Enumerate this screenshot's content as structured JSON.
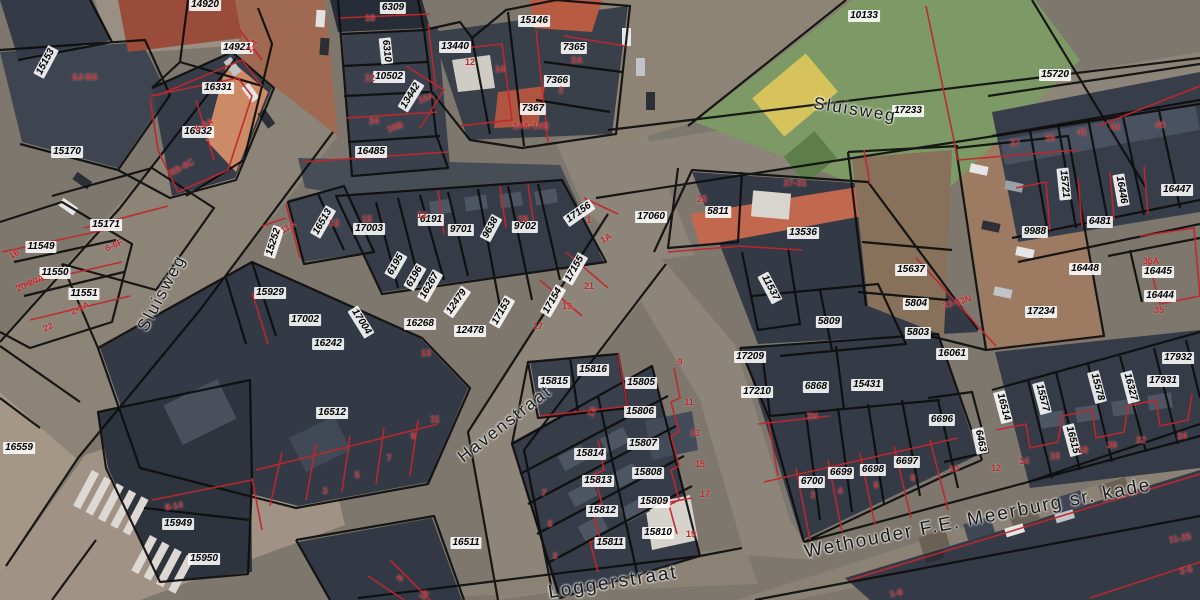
{
  "map": {
    "type": "cadastral-aerial-map",
    "colors": {
      "parcel_line": "#0d0d0d",
      "subdivision_line": "#c1272d",
      "house_number_text": "#c1272d",
      "parcel_label_bg": "#ffffff",
      "parcel_label_text": "#000000",
      "street_label_text": "#1a1a1a"
    },
    "streets": [
      {
        "name": "Sluisweg",
        "x": 855,
        "y": 110,
        "rot": 9,
        "size": 17
      },
      {
        "name": "Sluisweg",
        "x": 162,
        "y": 293,
        "rot": -62,
        "size": 17
      },
      {
        "name": "Havenstraat",
        "x": 505,
        "y": 424,
        "rot": -38,
        "size": 17
      },
      {
        "name": "Loggerstraat",
        "x": 613,
        "y": 583,
        "rot": -9,
        "size": 19
      },
      {
        "name": "Wethouder F.E. Meerburg sr. kade",
        "x": 978,
        "y": 519,
        "rot": -11,
        "size": 19
      }
    ],
    "parcel_labels": [
      {
        "id": "14920",
        "x": 205,
        "y": 5
      },
      {
        "id": "14921",
        "x": 237,
        "y": 48
      },
      {
        "id": "15153",
        "x": 46,
        "y": 62,
        "rot": -62
      },
      {
        "id": "16331",
        "x": 218,
        "y": 88
      },
      {
        "id": "16332",
        "x": 198,
        "y": 132
      },
      {
        "id": "15170",
        "x": 67,
        "y": 152
      },
      {
        "id": "6309",
        "x": 393,
        "y": 8
      },
      {
        "id": "6310",
        "x": 386,
        "y": 51,
        "rot": 84
      },
      {
        "id": "10502",
        "x": 389,
        "y": 77
      },
      {
        "id": "13442",
        "x": 411,
        "y": 96,
        "rot": -58
      },
      {
        "id": "16485",
        "x": 371,
        "y": 152
      },
      {
        "id": "13440",
        "x": 455,
        "y": 47
      },
      {
        "id": "15146",
        "x": 534,
        "y": 21
      },
      {
        "id": "7365",
        "x": 574,
        "y": 48
      },
      {
        "id": "7366",
        "x": 557,
        "y": 81
      },
      {
        "id": "7367",
        "x": 533,
        "y": 109
      },
      {
        "id": "10133",
        "x": 864,
        "y": 16
      },
      {
        "id": "17233",
        "x": 908,
        "y": 111
      },
      {
        "id": "15720",
        "x": 1055,
        "y": 75
      },
      {
        "id": "15721",
        "x": 1064,
        "y": 184,
        "rot": 84
      },
      {
        "id": "16446",
        "x": 1121,
        "y": 190,
        "rot": 80
      },
      {
        "id": "16447",
        "x": 1177,
        "y": 190
      },
      {
        "id": "9988",
        "x": 1035,
        "y": 232
      },
      {
        "id": "6481",
        "x": 1100,
        "y": 222
      },
      {
        "id": "16448",
        "x": 1085,
        "y": 269
      },
      {
        "id": "16445",
        "x": 1158,
        "y": 272
      },
      {
        "id": "16444",
        "x": 1160,
        "y": 296
      },
      {
        "id": "17234",
        "x": 1041,
        "y": 312
      },
      {
        "id": "17060",
        "x": 651,
        "y": 217
      },
      {
        "id": "5811",
        "x": 718,
        "y": 212
      },
      {
        "id": "13536",
        "x": 803,
        "y": 233
      },
      {
        "id": "15637",
        "x": 911,
        "y": 270
      },
      {
        "id": "5804",
        "x": 916,
        "y": 304
      },
      {
        "id": "5809",
        "x": 829,
        "y": 322
      },
      {
        "id": "5803",
        "x": 918,
        "y": 333
      },
      {
        "id": "11537",
        "x": 770,
        "y": 288,
        "rot": 62
      },
      {
        "id": "16061",
        "x": 952,
        "y": 354
      },
      {
        "id": "17209",
        "x": 750,
        "y": 357
      },
      {
        "id": "17210",
        "x": 757,
        "y": 392
      },
      {
        "id": "6868",
        "x": 816,
        "y": 387
      },
      {
        "id": "15431",
        "x": 867,
        "y": 385
      },
      {
        "id": "6696",
        "x": 942,
        "y": 420
      },
      {
        "id": "6697",
        "x": 907,
        "y": 462
      },
      {
        "id": "6698",
        "x": 873,
        "y": 470
      },
      {
        "id": "6699",
        "x": 841,
        "y": 473
      },
      {
        "id": "6700",
        "x": 812,
        "y": 482
      },
      {
        "id": "6463",
        "x": 980,
        "y": 441,
        "rot": 78
      },
      {
        "id": "17932",
        "x": 1178,
        "y": 358
      },
      {
        "id": "17931",
        "x": 1163,
        "y": 381
      },
      {
        "id": "16327",
        "x": 1130,
        "y": 387,
        "rot": 75
      },
      {
        "id": "15578",
        "x": 1097,
        "y": 387,
        "rot": 75
      },
      {
        "id": "15577",
        "x": 1042,
        "y": 398,
        "rot": 75
      },
      {
        "id": "16514",
        "x": 1003,
        "y": 407,
        "rot": 75
      },
      {
        "id": "16515",
        "x": 1072,
        "y": 440,
        "rot": 75
      },
      {
        "id": "15252",
        "x": 274,
        "y": 242,
        "rot": -72
      },
      {
        "id": "15929",
        "x": 270,
        "y": 293
      },
      {
        "id": "15171",
        "x": 106,
        "y": 225
      },
      {
        "id": "11549",
        "x": 41,
        "y": 247
      },
      {
        "id": "11550",
        "x": 55,
        "y": 273
      },
      {
        "id": "11551",
        "x": 84,
        "y": 294
      },
      {
        "id": "17002",
        "x": 305,
        "y": 320
      },
      {
        "id": "17004",
        "x": 361,
        "y": 322,
        "rot": 58
      },
      {
        "id": "16242",
        "x": 328,
        "y": 344
      },
      {
        "id": "16512",
        "x": 332,
        "y": 413
      },
      {
        "id": "17003",
        "x": 369,
        "y": 229
      },
      {
        "id": "16513",
        "x": 323,
        "y": 222,
        "rot": -60
      },
      {
        "id": "6191",
        "x": 431,
        "y": 220
      },
      {
        "id": "9701",
        "x": 461,
        "y": 230
      },
      {
        "id": "9638",
        "x": 491,
        "y": 228,
        "rot": -62
      },
      {
        "id": "9702",
        "x": 525,
        "y": 227
      },
      {
        "id": "17156",
        "x": 579,
        "y": 213,
        "rot": -35
      },
      {
        "id": "6195",
        "x": 396,
        "y": 265,
        "rot": -60
      },
      {
        "id": "6196",
        "x": 415,
        "y": 277,
        "rot": -60
      },
      {
        "id": "16267",
        "x": 430,
        "y": 286,
        "rot": -60
      },
      {
        "id": "12479",
        "x": 457,
        "y": 302,
        "rot": -55
      },
      {
        "id": "17153",
        "x": 502,
        "y": 312,
        "rot": -60
      },
      {
        "id": "17154",
        "x": 553,
        "y": 301,
        "rot": -60
      },
      {
        "id": "17155",
        "x": 575,
        "y": 269,
        "rot": -60
      },
      {
        "id": "16268",
        "x": 420,
        "y": 324
      },
      {
        "id": "12478",
        "x": 470,
        "y": 331
      },
      {
        "id": "15816",
        "x": 593,
        "y": 370
      },
      {
        "id": "15815",
        "x": 554,
        "y": 382
      },
      {
        "id": "15805",
        "x": 641,
        "y": 383
      },
      {
        "id": "15806",
        "x": 640,
        "y": 412
      },
      {
        "id": "15807",
        "x": 643,
        "y": 444
      },
      {
        "id": "15808",
        "x": 648,
        "y": 473
      },
      {
        "id": "15809",
        "x": 654,
        "y": 502
      },
      {
        "id": "15810",
        "x": 658,
        "y": 533
      },
      {
        "id": "15811",
        "x": 610,
        "y": 543
      },
      {
        "id": "15812",
        "x": 602,
        "y": 511
      },
      {
        "id": "15813",
        "x": 598,
        "y": 481
      },
      {
        "id": "15814",
        "x": 590,
        "y": 454
      },
      {
        "id": "16511",
        "x": 466,
        "y": 543
      },
      {
        "id": "15949",
        "x": 178,
        "y": 524
      },
      {
        "id": "15950",
        "x": 204,
        "y": 559
      },
      {
        "id": "16559",
        "x": 19,
        "y": 448
      }
    ],
    "house_numbers": [
      {
        "n": "2-4",
        "x": 252,
        "y": 46,
        "rot": -55
      },
      {
        "n": "6J-6G",
        "x": 85,
        "y": 77
      },
      {
        "n": "8-8A",
        "x": 204,
        "y": 125,
        "rot": -28
      },
      {
        "n": "8B-8C",
        "x": 182,
        "y": 167,
        "rot": -28
      },
      {
        "n": "18",
        "x": 370,
        "y": 18
      },
      {
        "n": "22",
        "x": 370,
        "y": 78
      },
      {
        "n": "24",
        "x": 374,
        "y": 121
      },
      {
        "n": "10A",
        "x": 426,
        "y": 98,
        "rot": -20
      },
      {
        "n": "10B",
        "x": 395,
        "y": 127,
        "rot": -20
      },
      {
        "n": "12",
        "x": 470,
        "y": 62
      },
      {
        "n": "14",
        "x": 500,
        "y": 69
      },
      {
        "n": "2A",
        "x": 577,
        "y": 60
      },
      {
        "n": "2",
        "x": 561,
        "y": 90
      },
      {
        "n": "14A-14B",
        "x": 531,
        "y": 126
      },
      {
        "n": "16",
        "x": 14,
        "y": 254,
        "rot": -30
      },
      {
        "n": "20-20A",
        "x": 30,
        "y": 283,
        "rot": -25
      },
      {
        "n": "2-2A",
        "x": 80,
        "y": 308,
        "rot": -25
      },
      {
        "n": "22",
        "x": 48,
        "y": 327,
        "rot": -25
      },
      {
        "n": "6-6F",
        "x": 114,
        "y": 245,
        "rot": -25
      },
      {
        "n": "11A",
        "x": 288,
        "y": 227,
        "rot": -30
      },
      {
        "n": "13",
        "x": 334,
        "y": 223
      },
      {
        "n": "15",
        "x": 367,
        "y": 219
      },
      {
        "n": "12",
        "x": 422,
        "y": 215
      },
      {
        "n": "19",
        "x": 523,
        "y": 219
      },
      {
        "n": "1",
        "x": 589,
        "y": 220
      },
      {
        "n": "1A",
        "x": 606,
        "y": 238,
        "rot": -30
      },
      {
        "n": "21",
        "x": 589,
        "y": 286
      },
      {
        "n": "19",
        "x": 567,
        "y": 306
      },
      {
        "n": "17",
        "x": 538,
        "y": 326
      },
      {
        "n": "13",
        "x": 426,
        "y": 353
      },
      {
        "n": "11",
        "x": 435,
        "y": 419
      },
      {
        "n": "9",
        "x": 413,
        "y": 436
      },
      {
        "n": "7",
        "x": 389,
        "y": 458
      },
      {
        "n": "5",
        "x": 357,
        "y": 475
      },
      {
        "n": "3",
        "x": 325,
        "y": 491
      },
      {
        "n": "25",
        "x": 702,
        "y": 199
      },
      {
        "n": "27-31",
        "x": 795,
        "y": 183
      },
      {
        "n": "33-33N",
        "x": 957,
        "y": 302,
        "rot": -15
      },
      {
        "n": "2H",
        "x": 812,
        "y": 416
      },
      {
        "n": "2",
        "x": 813,
        "y": 495
      },
      {
        "n": "4",
        "x": 840,
        "y": 491
      },
      {
        "n": "6",
        "x": 876,
        "y": 485
      },
      {
        "n": "8",
        "x": 913,
        "y": 478
      },
      {
        "n": "10",
        "x": 954,
        "y": 469
      },
      {
        "n": "12",
        "x": 996,
        "y": 468
      },
      {
        "n": "37",
        "x": 1015,
        "y": 143
      },
      {
        "n": "39",
        "x": 1050,
        "y": 138
      },
      {
        "n": "41",
        "x": 1082,
        "y": 132
      },
      {
        "n": "43",
        "x": 1115,
        "y": 127
      },
      {
        "n": "45",
        "x": 1160,
        "y": 125
      },
      {
        "n": "35A",
        "x": 1151,
        "y": 261
      },
      {
        "n": "35",
        "x": 1159,
        "y": 310
      },
      {
        "n": "14",
        "x": 1024,
        "y": 461
      },
      {
        "n": "16",
        "x": 1055,
        "y": 456
      },
      {
        "n": "18",
        "x": 1083,
        "y": 450
      },
      {
        "n": "20",
        "x": 1112,
        "y": 445
      },
      {
        "n": "22",
        "x": 1141,
        "y": 440
      },
      {
        "n": "24",
        "x": 1182,
        "y": 436
      },
      {
        "n": "11-25",
        "x": 1180,
        "y": 538,
        "rot": -10
      },
      {
        "n": "2-5",
        "x": 1186,
        "y": 570,
        "rot": -15
      },
      {
        "n": "1-9",
        "x": 896,
        "y": 593,
        "rot": -12
      },
      {
        "n": "8-14",
        "x": 174,
        "y": 506,
        "rot": -10
      },
      {
        "n": "9",
        "x": 680,
        "y": 362
      },
      {
        "n": "11",
        "x": 689,
        "y": 402
      },
      {
        "n": "13",
        "x": 695,
        "y": 433
      },
      {
        "n": "15",
        "x": 700,
        "y": 464
      },
      {
        "n": "17",
        "x": 705,
        "y": 494
      },
      {
        "n": "19",
        "x": 691,
        "y": 534
      },
      {
        "n": "10",
        "x": 592,
        "y": 412,
        "rot": -62
      },
      {
        "n": "3",
        "x": 555,
        "y": 556
      },
      {
        "n": "5",
        "x": 550,
        "y": 524
      },
      {
        "n": "7",
        "x": 544,
        "y": 493
      },
      {
        "n": "8",
        "x": 400,
        "y": 578,
        "rot": -55
      },
      {
        "n": "10",
        "x": 424,
        "y": 595,
        "rot": -55
      }
    ]
  }
}
